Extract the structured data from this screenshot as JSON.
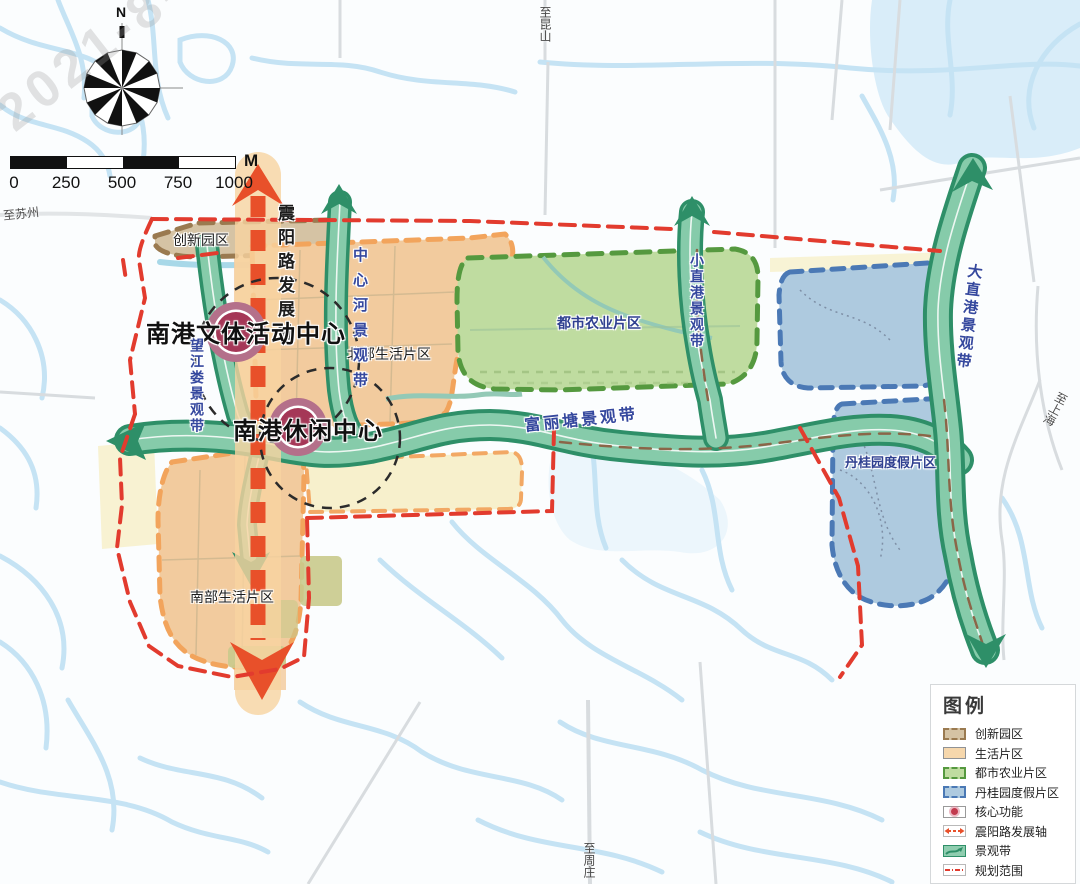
{
  "watermark": "2021-8-8",
  "compass": {
    "north": "N"
  },
  "scale_bar": {
    "ticks": [
      "0",
      "250",
      "500",
      "750",
      "1000"
    ],
    "unit": "M"
  },
  "edges": {
    "suzhou": "至苏州",
    "kunshan": "至昆山",
    "shanghai": "至上海",
    "zhouzhuang": "至周庄"
  },
  "centers": {
    "culture_sports": "南港文体活动中心",
    "leisure": "南港休闲中心"
  },
  "regions": {
    "innovation": "创新园区",
    "north_living": "北部生活片区",
    "south_living": "南部生活片区",
    "agriculture": "都市农业片区",
    "resort": "丹桂园度假片区"
  },
  "belts": {
    "zhenyang": "震阳路发展轴",
    "zhongxinhe": "中心河景观带",
    "wangjianglou": "望江娄景观带",
    "fulitang": "富丽塘景观带",
    "xiaozhigang": "小直港景观带",
    "dazhigang": "大直港景观带"
  },
  "legend": {
    "title": "图例",
    "items": [
      {
        "label": "创新园区",
        "swatch": "innovation"
      },
      {
        "label": "生活片区",
        "swatch": "living"
      },
      {
        "label": "都市农业片区",
        "swatch": "agriculture"
      },
      {
        "label": "丹桂园度假片区",
        "swatch": "resort"
      },
      {
        "label": "核心功能",
        "swatch": "core"
      },
      {
        "label": "震阳路发展轴",
        "swatch": "axis"
      },
      {
        "label": "景观带",
        "swatch": "belt"
      },
      {
        "label": "规划范围",
        "swatch": "boundary"
      }
    ]
  },
  "colors": {
    "axis_orange": "#E8502A",
    "belt_green": "#2E8F68",
    "boundary_red": "#E23B2E",
    "core_red": "#A53757",
    "living_peach": "#F2CB9E",
    "agriculture_green": "#BFDCA0",
    "resort_blue": "#AECADF",
    "innovation_tan": "#D5C3A4"
  }
}
